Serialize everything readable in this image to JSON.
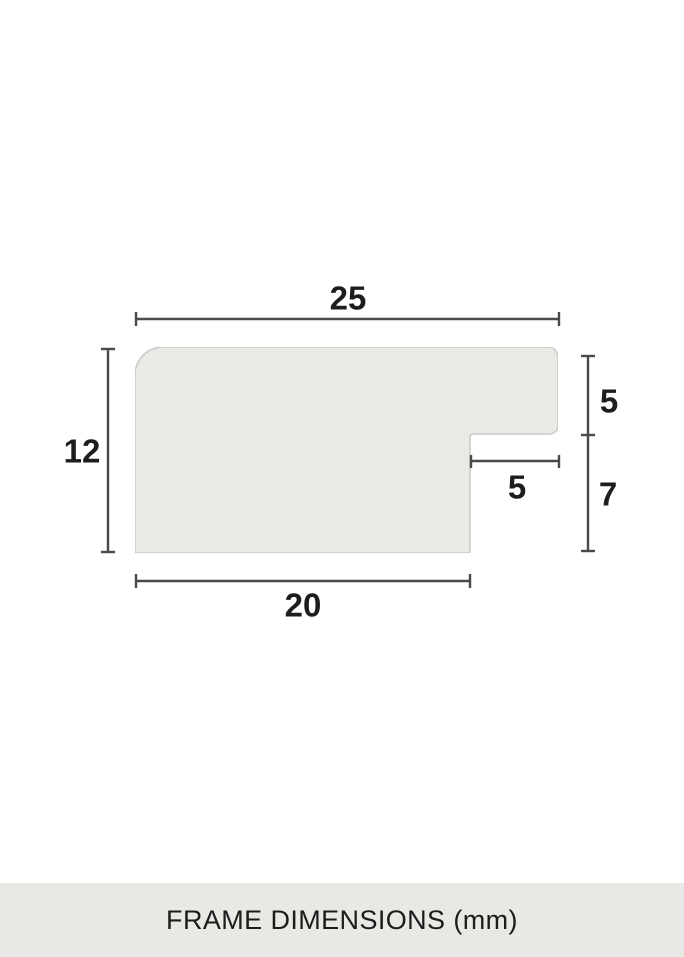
{
  "diagram": {
    "title": "frame-profile-cross-section",
    "unit": "mm",
    "dimensions": {
      "top_width": "25",
      "left_height": "12",
      "right_upper_height": "5",
      "right_lower_height": "7",
      "rabbet_width": "5",
      "bottom_width": "20"
    }
  },
  "caption": {
    "text": "FRAME DIMENSIONS (mm)"
  },
  "colors": {
    "background": "#ffffff",
    "profile_fill": "#e9e9e6",
    "profile_border": "#c9c9c5",
    "dimension_line": "#4a4a4a",
    "label_text": "#1d1d1d",
    "caption_bg": "#e8e8e4"
  }
}
